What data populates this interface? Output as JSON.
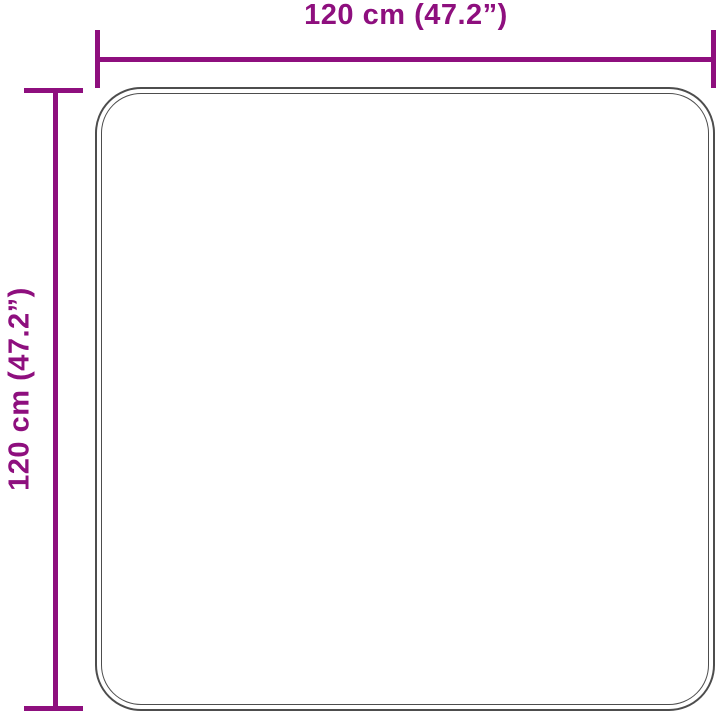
{
  "diagram": {
    "type": "product-dimension-diagram",
    "subject": "square rug outline",
    "width_label": "120 cm (47.2”)",
    "height_label": "120 cm (47.2”)",
    "width_cm": 120,
    "height_cm": 120,
    "width_inches": 47.2,
    "height_inches": 47.2
  },
  "colors": {
    "dimension_accent": "#8E0F7E",
    "rug_outline": "#4D4D4D",
    "background": "#FFFFFF"
  }
}
